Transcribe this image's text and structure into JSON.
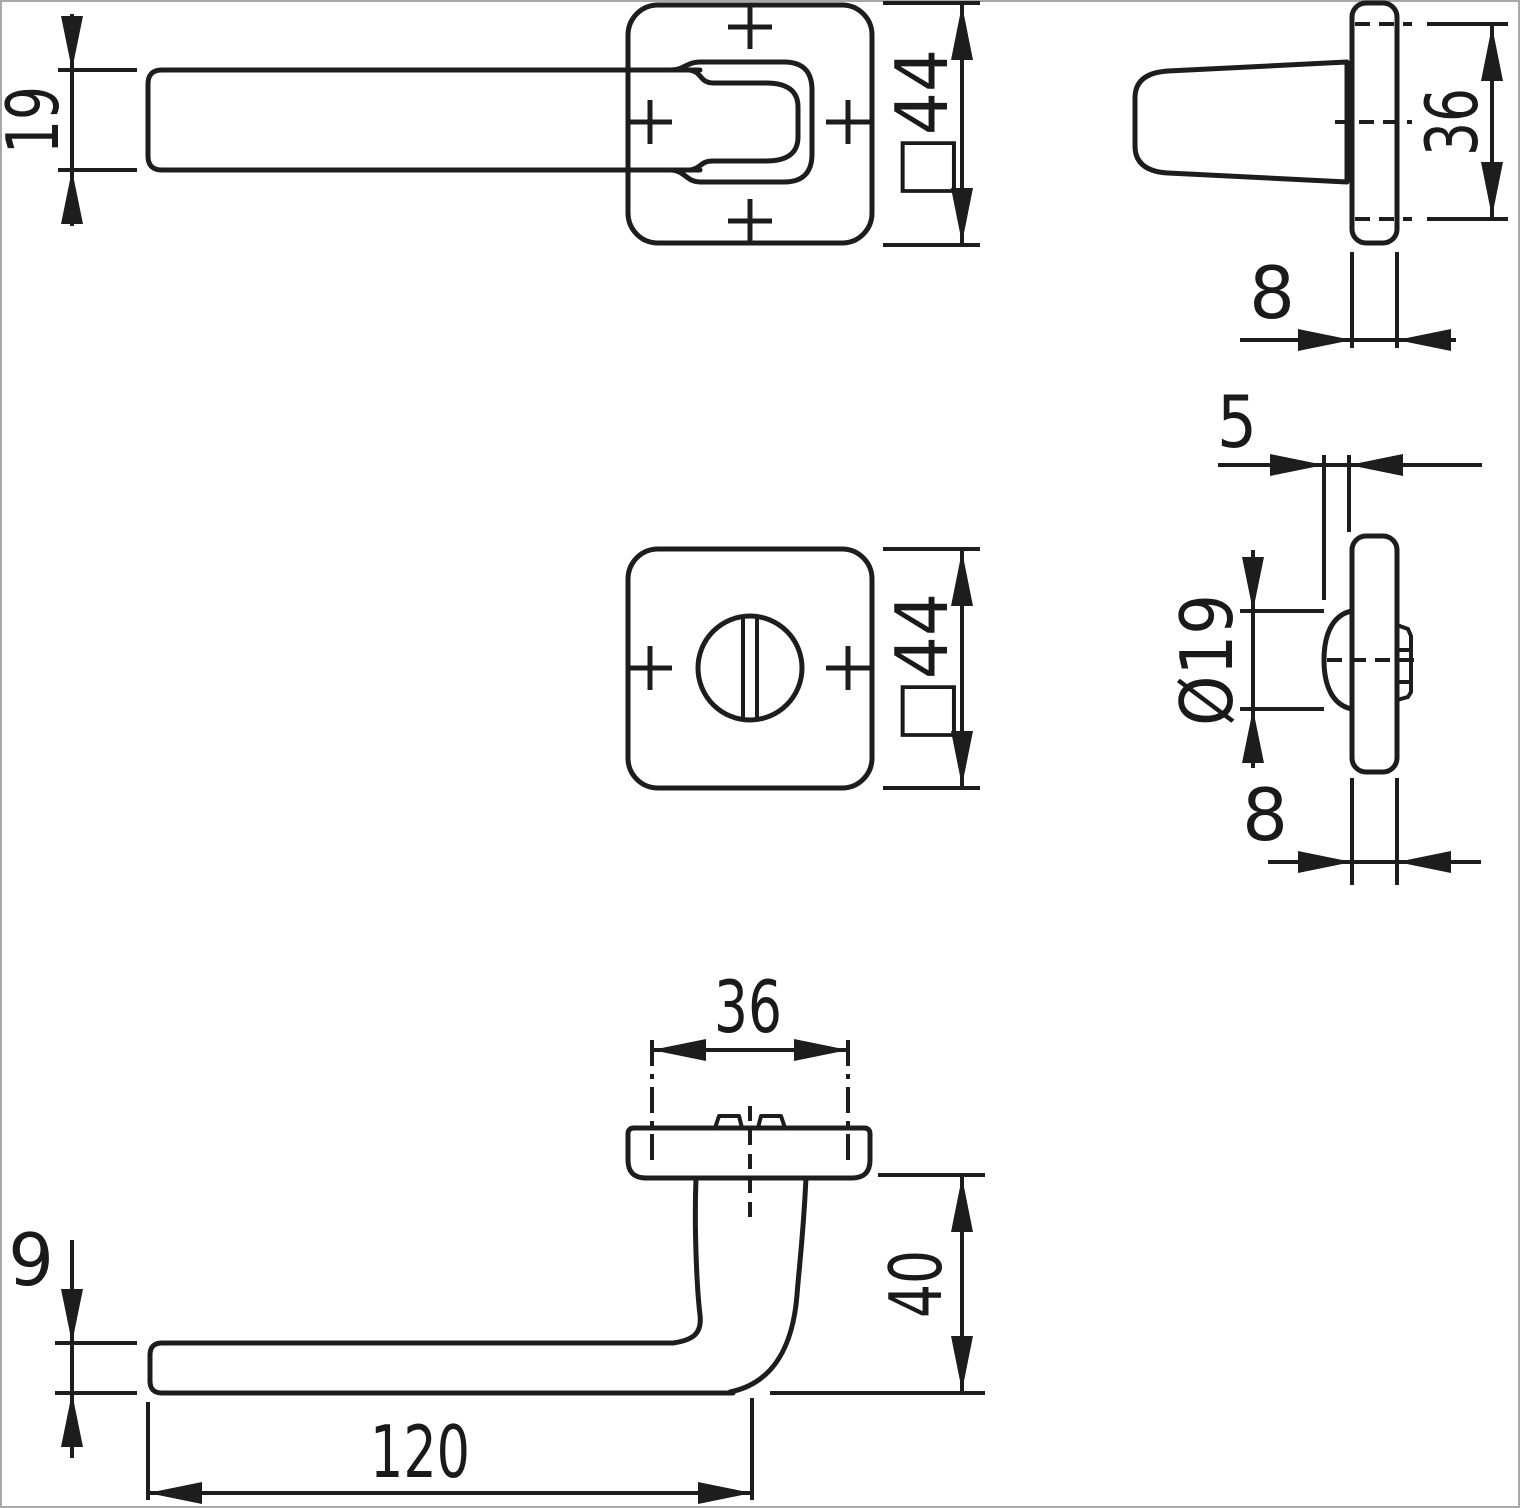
{
  "drawing": {
    "kind": "door-handle-dimension-drawing",
    "background": "#ffffff",
    "line_color": "#1d1d1d",
    "border_color": "#a8a8a8",
    "views": {
      "lever_top": {
        "name": "handle with square rosette, top view",
        "dims": {
          "lever_width": "19",
          "rosette": "□44"
        }
      },
      "grip_side": {
        "name": "handle grip with rosette, side view",
        "dims": {
          "grip_span": "36",
          "rosette_depth": "8"
        }
      },
      "turn_front": {
        "name": "thumbturn square rosette, front view",
        "dims": {
          "rosette": "□44"
        }
      },
      "turn_side": {
        "name": "thumbturn rosette, side view",
        "dims": {
          "knob_offset": "5",
          "knob_diameter": "Ø19",
          "rosette_depth": "8"
        }
      },
      "lever_front": {
        "name": "handle lever, front view",
        "dims": {
          "fixing_span": "36",
          "projection": "40",
          "lever_thickness": "9",
          "lever_length": "120"
        }
      }
    }
  }
}
